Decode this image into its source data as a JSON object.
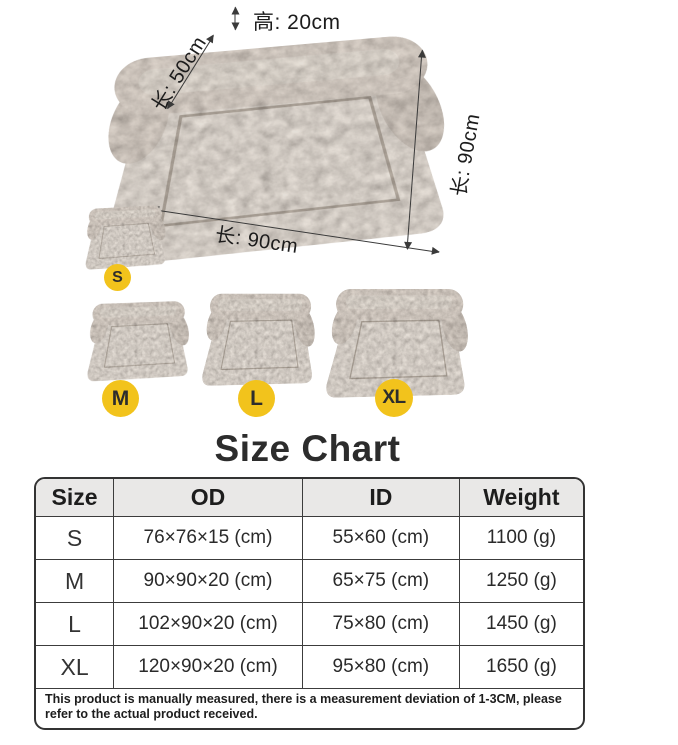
{
  "diagram": {
    "height_label": "高: 20cm",
    "side_label": "长: 50cm",
    "right_label": "长: 90cm",
    "bottom_label": "长: 90cm"
  },
  "size_badges": [
    {
      "label": "S"
    },
    {
      "label": "M"
    },
    {
      "label": "L"
    },
    {
      "label": "XL"
    }
  ],
  "size_chart": {
    "title": "Size Chart",
    "headers": [
      "Size",
      "OD",
      "ID",
      "Weight"
    ],
    "rows": [
      [
        "S",
        "76×76×15 (cm)",
        "55×60 (cm)",
        "1100 (g)"
      ],
      [
        "M",
        "90×90×20 (cm)",
        "65×75 (cm)",
        "1250 (g)"
      ],
      [
        "L",
        "102×90×20 (cm)",
        "75×80 (cm)",
        "1450 (g)"
      ],
      [
        "XL",
        "120×90×20 (cm)",
        "95×80 (cm)",
        "1650 (g)"
      ]
    ],
    "note": "This product is manually measured, there is a measurement deviation of 1-3CM, please refer to the actual product received."
  },
  "colors": {
    "badge_yellow": "#F2C31C",
    "table_border": "#333333",
    "header_bg": "#E9E8E7",
    "text_dark": "#1d1d1d"
  }
}
